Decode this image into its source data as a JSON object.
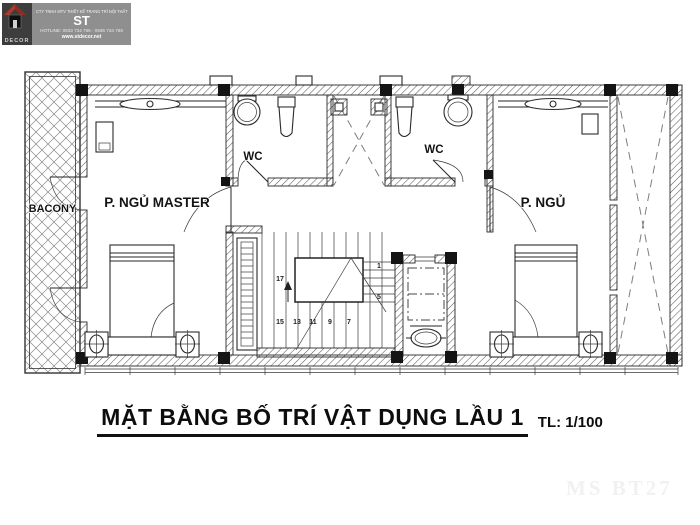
{
  "logo": {
    "brand": "DECOR",
    "company": "CTY TNHH MTV THIẾT KẾ TRANG TRÍ NỘI THẤT",
    "brand_short": "ST",
    "hotline": "HOTLINE: 0933 734 766 - 0936 734 766",
    "website": "www.stdecor.net"
  },
  "plan": {
    "labels": {
      "balcony": "BACONY",
      "master_bedroom": "P. NGỦ MASTER",
      "wc_left": "WC",
      "wc_right": "WC",
      "bedroom": "P. NGỦ"
    },
    "stair_numbers": [
      "1",
      "5",
      "7",
      "9",
      "11",
      "13",
      "15",
      "17"
    ]
  },
  "title": {
    "text": "MẶT BẰNG BỐ TRÍ VẬT DỤNG LẦU 1",
    "scale": "TL: 1/100"
  },
  "watermark": "MS BT27",
  "colors": {
    "ink": "#1c1c1c",
    "wall_hatch": "#555555",
    "logo_panel": "#8f8f8f",
    "logo_tile": "#3d3d3d",
    "logo_red": "#b03a2e",
    "watermark": "#f1f1f1"
  }
}
